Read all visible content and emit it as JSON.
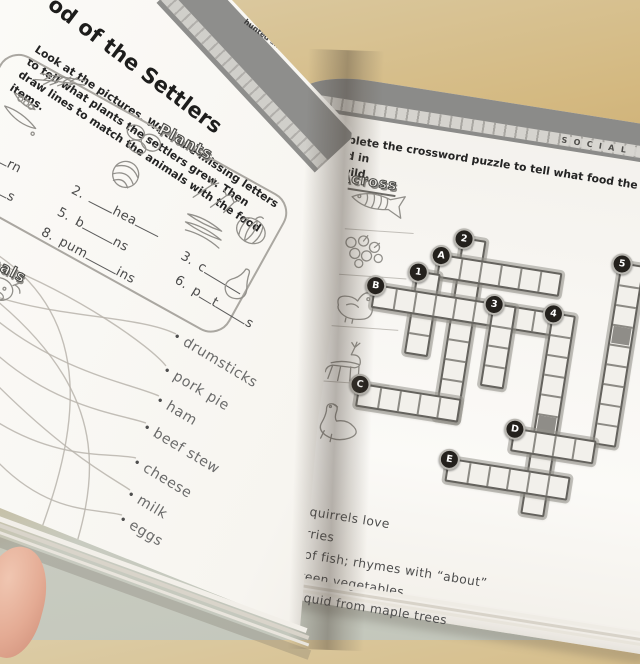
{
  "photo": {
    "background_top_color": "#d4b981",
    "background_bottom_color": "#c6cabf",
    "paper_color": "#f7f5f1",
    "band_gray": "#8b8b89",
    "badge_black": "#24211d",
    "shaded_cell_color": "#8f8d88"
  },
  "left_page": {
    "title": "od of the Settlers",
    "intro_lines": [
      [
        {
          "t": "The settlers "
        },
        {
          "b": "grew"
        },
        {
          "t": " plants and "
        },
        {
          "b": "raised"
        },
        {
          "t": " animals."
        }
      ],
      [
        {
          "b": "hunted"
        },
        {
          "t": " and "
        },
        {
          "b": "foraged"
        },
        {
          "t": " for food in the wild."
        }
      ]
    ],
    "instruction": "Look at the pictures.  Write the missing letters to tell what plants the settlers grew.  Then draw lines to match the animals with the food items.",
    "plants_label": "Plants",
    "animals_label": "Animals",
    "plant_pictures": [
      "wheat",
      "peas",
      "potatoes",
      "cabbage",
      "herbs",
      "beans",
      "pumpkin",
      "squash",
      "cow"
    ],
    "plant_blanks": [
      {
        "num": "",
        "segs": [
          22,
          "rn"
        ]
      },
      {
        "num": "",
        "segs": [
          22,
          "s"
        ]
      },
      {
        "num": "2.",
        "segs": [
          26,
          "hea",
          26
        ]
      },
      {
        "num": "5.",
        "segs": [
          "b",
          34,
          "ns"
        ]
      },
      {
        "num": "8.",
        "segs": [
          "pum",
          34,
          "ins"
        ]
      },
      {
        "num": "3.",
        "segs": [
          "c",
          42
        ]
      },
      {
        "num": "6.",
        "segs": [
          "p",
          14,
          "t",
          34,
          "s"
        ]
      }
    ],
    "food_words": [
      "drumsticks",
      "pork pie",
      "ham",
      "beef stew",
      "cheese",
      "milk",
      "eggs"
    ]
  },
  "right_page": {
    "tab": "SOCIAL STUDIE",
    "exercise_label": "B.",
    "instruction_lines": [
      "Complete the crossword puzzle to tell what food the settlers found in",
      "the wild."
    ],
    "across_label": "Across",
    "across_pictures": [
      {
        "letter": "A",
        "picture": "fish"
      },
      {
        "letter": "B",
        "picture": "berries"
      },
      {
        "letter": "C",
        "picture": "duck"
      },
      {
        "letter": "D",
        "picture": "deer"
      },
      {
        "letter": "E",
        "picture": "goose"
      }
    ],
    "down_label": "Down",
    "down_clues": [
      {
        "num": "1.",
        "text": "what squirrels love"
      },
      {
        "num": "2.",
        "text": "red berries"
      },
      {
        "num": "3.",
        "text": "a kind of fish; rhymes with “about”"
      },
      {
        "num": "4.",
        "text": "wild, green vegetables"
      },
      {
        "num": "5.",
        "text": "sweet liquid from maple trees"
      }
    ],
    "crossword": {
      "cell_px": 20,
      "words": [
        {
          "label": "2",
          "dir": "down",
          "col": 4,
          "row": 0,
          "len": 9,
          "shaded": []
        },
        {
          "label": "5",
          "dir": "down",
          "col": 12,
          "row": 0,
          "len": 9,
          "shaded": [
            3
          ]
        },
        {
          "label": "A",
          "dir": "across",
          "col": 3,
          "row": 1,
          "len": 6,
          "shaded": []
        },
        {
          "label": "1",
          "dir": "down",
          "col": 2,
          "row": 2,
          "len": 4,
          "shaded": []
        },
        {
          "label": "B",
          "dir": "across",
          "col": 0,
          "row": 3,
          "len": 9,
          "shaded": []
        },
        {
          "label": "3",
          "dir": "down",
          "col": 6,
          "row": 3,
          "len": 4,
          "shaded": []
        },
        {
          "label": "4",
          "dir": "down",
          "col": 9,
          "row": 3,
          "len": 10,
          "shaded": [
            5
          ]
        },
        {
          "label": "C",
          "dir": "across",
          "col": 0,
          "row": 8,
          "len": 5,
          "shaded": []
        },
        {
          "label": "D",
          "dir": "across",
          "col": 8,
          "row": 9,
          "len": 4,
          "shaded": []
        },
        {
          "label": "E",
          "dir": "across",
          "col": 5,
          "row": 11,
          "len": 6,
          "shaded": []
        }
      ]
    }
  }
}
